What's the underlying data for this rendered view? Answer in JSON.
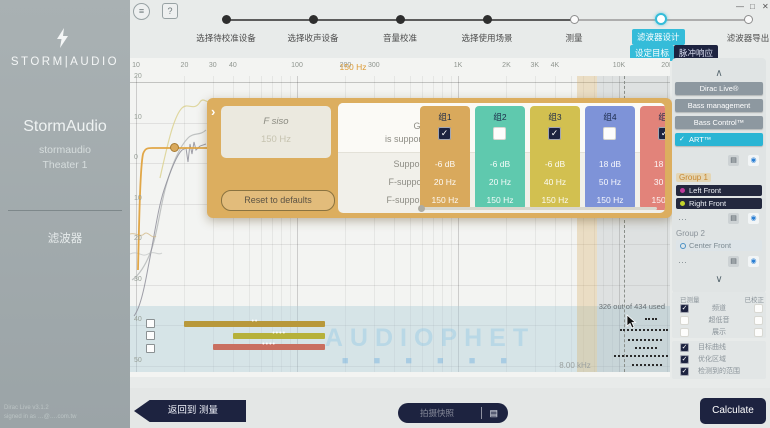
{
  "topbar": {
    "menu": "≡",
    "help": "?",
    "minimize": "—",
    "maximize": "□",
    "close": "✕"
  },
  "sidebar": {
    "brand": "STORM|AUDIO",
    "product": "StormAudio",
    "device": "stormaudio",
    "theater": "Theater 1",
    "nav": "滤波器",
    "version": "Dirac Live v3.1.2",
    "signed_in": "signed in as …@….com.tw"
  },
  "stepper": {
    "steps": [
      {
        "label": "选择待校准设备",
        "state": "done"
      },
      {
        "label": "选择收声设备",
        "state": "done"
      },
      {
        "label": "音量校准",
        "state": "done"
      },
      {
        "label": "选择使用场景",
        "state": "done"
      },
      {
        "label": "测量",
        "state": "open"
      },
      {
        "label": "滤波器设计",
        "state": "active"
      },
      {
        "label": "滤波器导出",
        "state": "open"
      }
    ],
    "subtabs": [
      {
        "label": "设定目标",
        "active": true
      },
      {
        "label": "脉冲响应",
        "active": false
      }
    ]
  },
  "chart": {
    "target_freq_label": "150 Hz",
    "curtain_label": "8.00 kHz",
    "used_label": "326 out of 434 used",
    "watermark": "AUDIOPHET",
    "watermark_sub": "■ ■ ■ ■ ■ ■",
    "freq_ticks": [
      {
        "f": 10,
        "label": "10"
      },
      {
        "f": 20,
        "label": "20"
      },
      {
        "f": 30,
        "label": "30"
      },
      {
        "f": 40,
        "label": "40"
      },
      {
        "f": 100,
        "label": "100"
      },
      {
        "f": 200,
        "label": "200"
      },
      {
        "f": 300,
        "label": "300"
      },
      {
        "f": 1000,
        "label": "1K"
      },
      {
        "f": 2000,
        "label": "2K"
      },
      {
        "f": 3000,
        "label": "3K"
      },
      {
        "f": 4000,
        "label": "4K"
      },
      {
        "f": 10000,
        "label": "10K"
      },
      {
        "f": 20000,
        "label": "20K"
      }
    ],
    "db_ticks": [
      "20",
      "10",
      "0",
      "10",
      "20",
      "30",
      "40",
      "50"
    ],
    "bars": [
      {
        "group": "组1",
        "f_low": 20,
        "f_high": 150,
        "color": "#b8983a",
        "dots": "••",
        "row_y": 263
      },
      {
        "group": "组3",
        "f_low": 40,
        "f_high": 150,
        "color": "#b6b13a",
        "dots": "••••",
        "row_y": 275
      },
      {
        "group": "组5",
        "f_low": 30,
        "f_high": 150,
        "color": "#c96f60",
        "dots": "••••",
        "row_y": 286
      }
    ]
  },
  "dialog": {
    "chevron": "›",
    "param_title": "F siso",
    "param_value": "150 Hz",
    "reset_label": "Reset to defaults",
    "row_labels": {
      "group": "Group 1",
      "supported": "is supported by",
      "level": "Support level",
      "f_low": "F-support Low",
      "f_high": "F-support High"
    },
    "groups": [
      {
        "name": "组1",
        "color": "#d9a95c",
        "checked": true,
        "level": "-6 dB",
        "f_low": "20 Hz",
        "f_high": "150 Hz"
      },
      {
        "name": "组2",
        "color": "#5fc9ae",
        "checked": false,
        "level": "-6 dB",
        "f_low": "20 Hz",
        "f_high": "150 Hz"
      },
      {
        "name": "组3",
        "color": "#d2c050",
        "checked": true,
        "level": "-6 dB",
        "f_low": "40 Hz",
        "f_high": "150 Hz"
      },
      {
        "name": "组4",
        "color": "#7e93d8",
        "checked": false,
        "level": "18 dB",
        "f_low": "50 Hz",
        "f_high": "150 Hz"
      },
      {
        "name": "组5",
        "color": "#e2837a",
        "checked": true,
        "level": "18 dB",
        "f_low": "30 Hz",
        "f_high": "150 Hz"
      }
    ]
  },
  "right_panel": {
    "collapse": "∧",
    "expand": "∨",
    "more": "⋯",
    "tabs": [
      {
        "label": "Dirac Live®",
        "active": false
      },
      {
        "label": "Bass management",
        "active": false
      },
      {
        "label": "Bass Control™",
        "active": false
      },
      {
        "label": "ART™",
        "active": true
      }
    ],
    "icons": {
      "snapshot": "▤",
      "target": "◉"
    },
    "group1": {
      "title": "Group 1",
      "channels": [
        {
          "label": "Left Front",
          "dot": "#bf3a9b"
        },
        {
          "label": "Right Front",
          "dot": "#c3d32c"
        }
      ]
    },
    "group2": {
      "title": "Group 2",
      "channels": [
        {
          "label": "Center Front"
        }
      ]
    }
  },
  "legend": {
    "measured": "已测量",
    "corrected": "已校正",
    "rows": [
      {
        "label": "频道",
        "measured": true,
        "corrected": false
      },
      {
        "label": "超低音",
        "measured": false,
        "corrected": false
      },
      {
        "label": "展示",
        "measured": false,
        "corrected": false
      }
    ],
    "overlays": [
      {
        "label": "目标曲线",
        "checked": true
      },
      {
        "label": "优化区域",
        "checked": true
      },
      {
        "label": "检测到的范围",
        "checked": true
      }
    ]
  },
  "bottom": {
    "back": "返回到 测量",
    "snapshot": "拍摄快照",
    "calculate": "Calculate"
  },
  "ui": {
    "check": "✓",
    "accent_cyan": "#35bcd9",
    "navy": "#1d2340",
    "dialog_orange": "#dcae5f"
  }
}
